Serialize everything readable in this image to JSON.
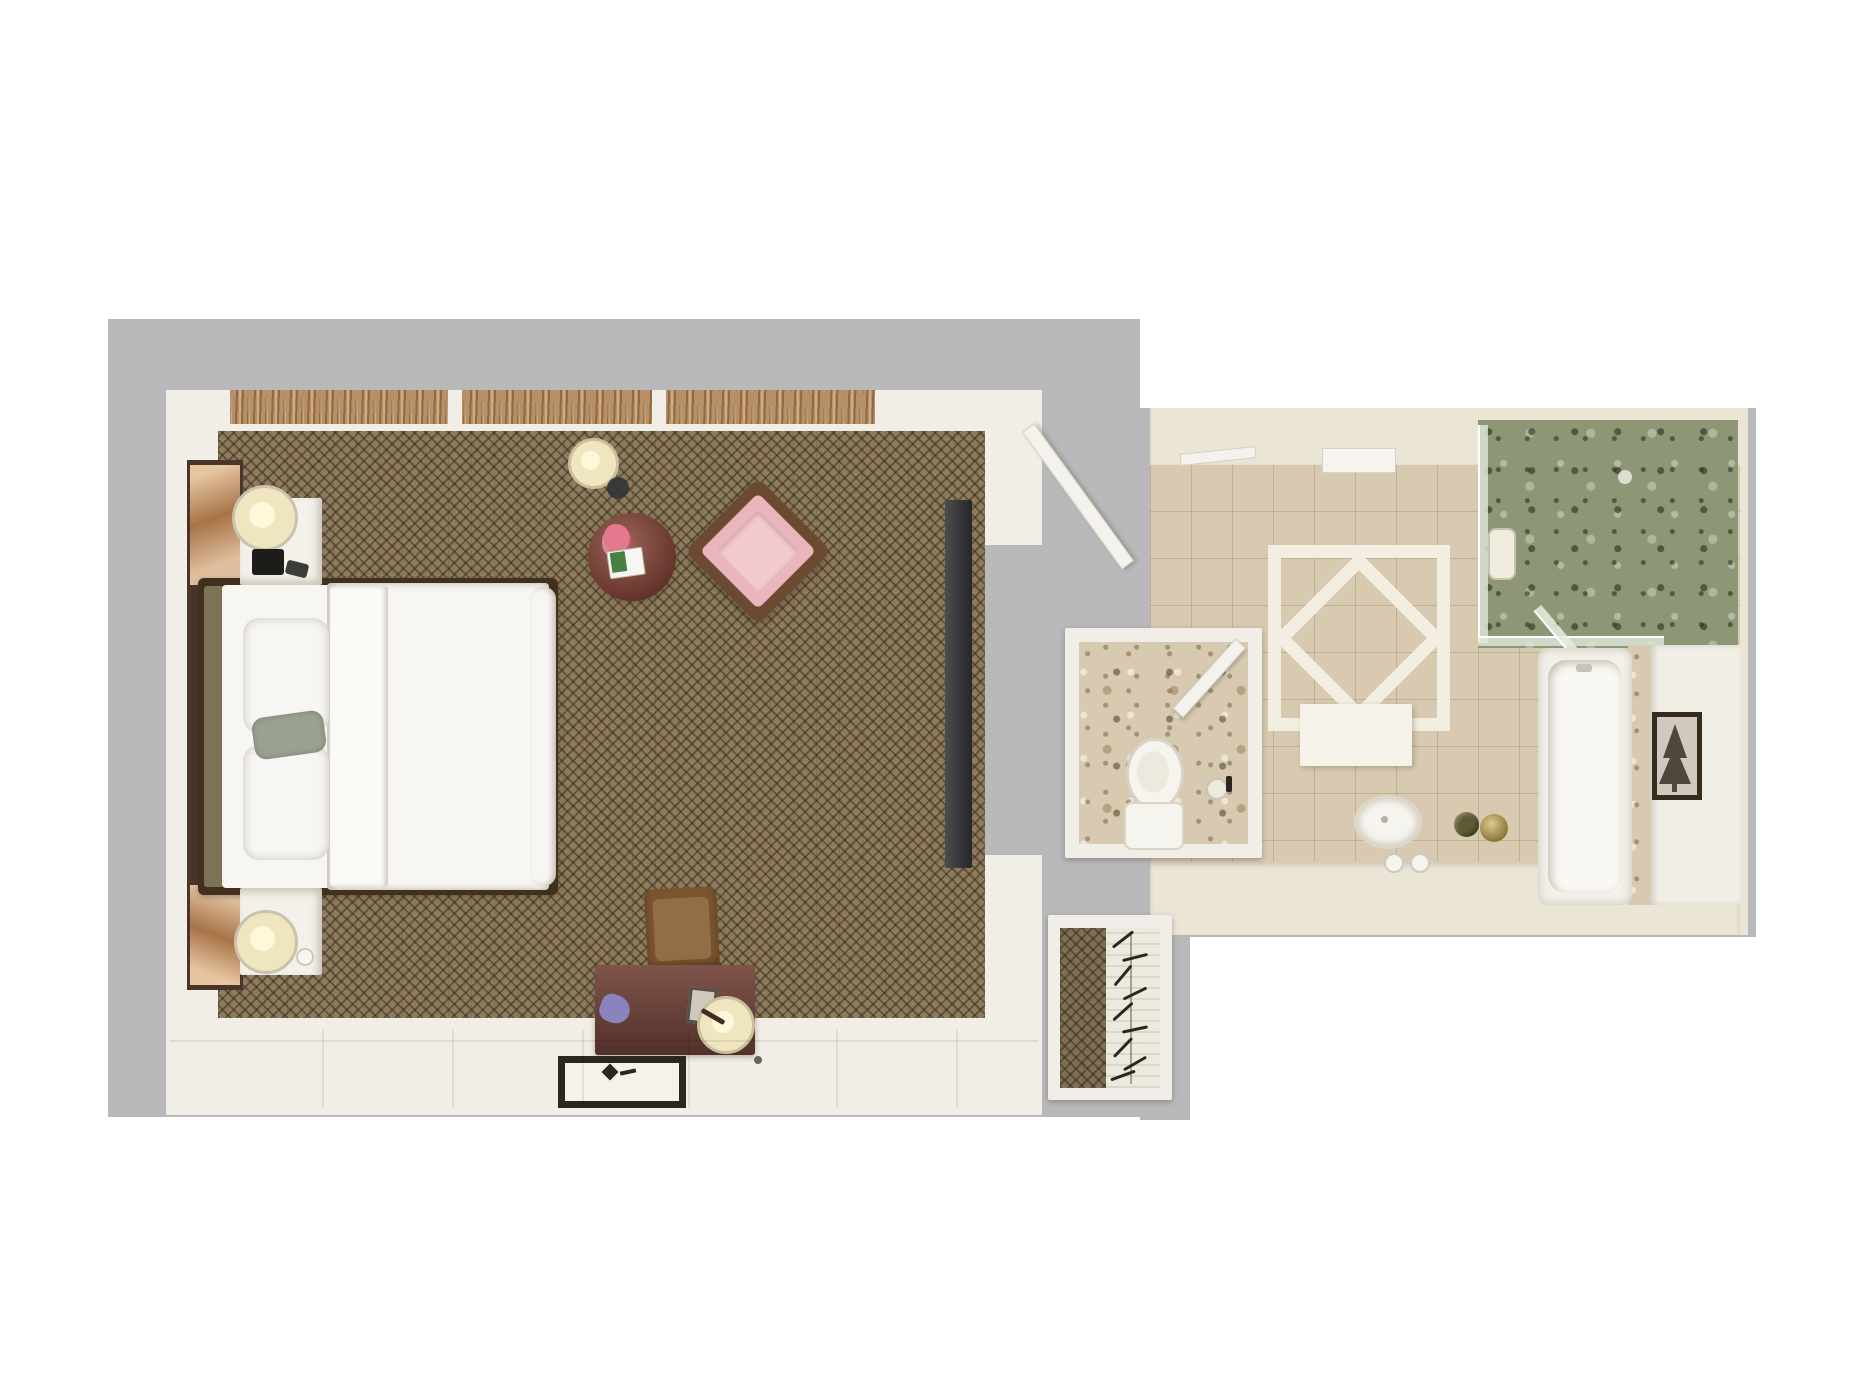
{
  "meta": {
    "description": "Photorealistic top-down 3D floor plan rendering of a hotel guest room with bedroom, bathroom, water closet and walk-in closet",
    "view": "top-down dollhouse render",
    "visible_text": ""
  },
  "colors": {
    "page_bg": "#ffffff",
    "pad_gray": "#b9b9bb",
    "wall_white": "#f1eee7",
    "wall_cream": "#ebe5d6",
    "carpet_brown": "#8d7b5c",
    "closet_carpet": "#7f6f52",
    "window_wood": "#b98f63",
    "headboard_wall_wood": "#4a3528",
    "art_panel_warm": "#c08c5e",
    "bed_frame_wood": "#42301f",
    "bedding_white": "#f7f6f2",
    "duvet_fold": "#fbfaf7",
    "pillow_gray": "#9aa092",
    "headboard_panel": "#7d7257",
    "nightstand_white": "#f3f1ea",
    "lamp_cream": "#efe5bf",
    "lamp_glow": "#fff7d9",
    "device_black": "#1d1c1a",
    "side_table_red": "#7b4137",
    "flower_pink": "#e2798c",
    "book_green": "#47813f",
    "armchair_frame": "#6b4a31",
    "armchair_pink": "#eab5bc",
    "armchair_seat": "#f2c9ce",
    "tv_dark": "#323437",
    "desk_wood": "#6d4138",
    "desk_chair_wood": "#7a552f",
    "purple_cloth": "#8b83bd",
    "mat_border_dark": "#2b2620",
    "granite_floor": "#d8cab0",
    "inlay_white": "#f2eee1",
    "rug_white": "#f5f2e9",
    "shower_marble_green": "#8d9775",
    "glass_tint": "#dde8dc",
    "niche_white": "#f0ece0",
    "tub_white": "#f3f1ea",
    "tub_inner": "#faf8f3",
    "deck_white": "#f1eee6",
    "art_frame_dark": "#352b1f",
    "art_paper": "#cfcabd",
    "tree_dark": "#4e483c",
    "gold_tray": "#a5893c",
    "plant_olive": "#5f5a33",
    "porcelain": "#f6f4ee",
    "porcelain_inner": "#eceadf",
    "garment_white": "#eceadf",
    "hanger_dark": "#2c261d",
    "door_white": "#f4f2ec"
  },
  "bedroom": {
    "furniture": [
      "king-bed",
      "upper-nightstand",
      "lower-nightstand",
      "upper-table-lamp",
      "lower-table-lamp",
      "floor-lamp",
      "round-side-table",
      "pink-armchair",
      "wall-tv",
      "writing-desk",
      "desk-chair",
      "desk-lamp",
      "entry-mat"
    ],
    "window_separators": [
      448,
      652
    ],
    "panel_grooves": [
      322,
      452,
      582,
      688,
      836,
      956
    ]
  },
  "bathroom": {
    "features": [
      "double-vanity-sink",
      "diamond-tile-inlay",
      "white-rug",
      "glass-shower",
      "soaking-tub",
      "framed-pine-art",
      "gold-tray",
      "potted-plant",
      "towel-bar"
    ]
  },
  "water_closet": {
    "features": [
      "toilet",
      "paper-holder",
      "swing-door"
    ]
  },
  "closet": {
    "features": [
      "hanging-rod",
      "garment-bags"
    ],
    "hangers": [
      {
        "top": 938,
        "angle": -38
      },
      {
        "top": 956,
        "angle": -14
      },
      {
        "top": 974,
        "angle": -50
      },
      {
        "top": 992,
        "angle": -26
      },
      {
        "top": 1010,
        "angle": -42
      },
      {
        "top": 1028,
        "angle": -12
      },
      {
        "top": 1046,
        "angle": -46
      },
      {
        "top": 1062,
        "angle": -30
      },
      {
        "top": 1074,
        "angle": -20
      }
    ]
  }
}
